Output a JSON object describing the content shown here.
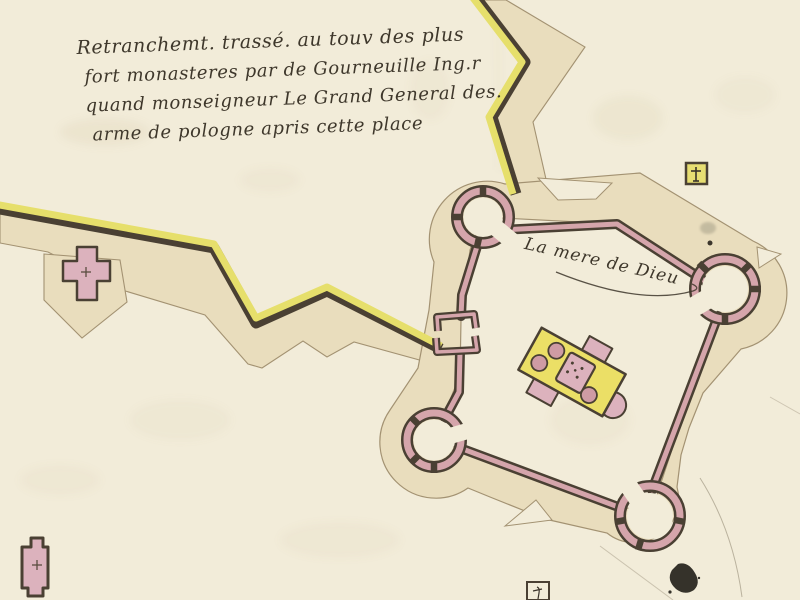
{
  "annotations": {
    "title_lines": [
      "Retranchemt. trassé. au touv des plus",
      "fort monasteres par de Gourneuille Ing.r",
      "quand monseigneur Le Grand General des.",
      "arme de pologne apris cette place"
    ],
    "fort_label": "La mere de Dieu"
  },
  "colors": {
    "paper": "#f2ecd9",
    "glacis_beige": "#e9ddbd",
    "rampart_yellow": "#e6df6b",
    "wall_pink": "#d5a5ab",
    "building_pink": "#dcb2bd",
    "outline_dark": "#4a4033",
    "ink": "#3e372b",
    "pencil": "#a39a85"
  },
  "symbols": {
    "fort": "pentagonal-fort-with-round-bastions",
    "monastery": "monastery-church-plan",
    "west_chapel": "cross-chapel-marker",
    "southwest_chapel": "chapel-building-marker",
    "northeast_marker": "yellow-cross-square-marker",
    "south_marker": "small-square-marker",
    "ink_blot": "ink-blot-stain"
  }
}
